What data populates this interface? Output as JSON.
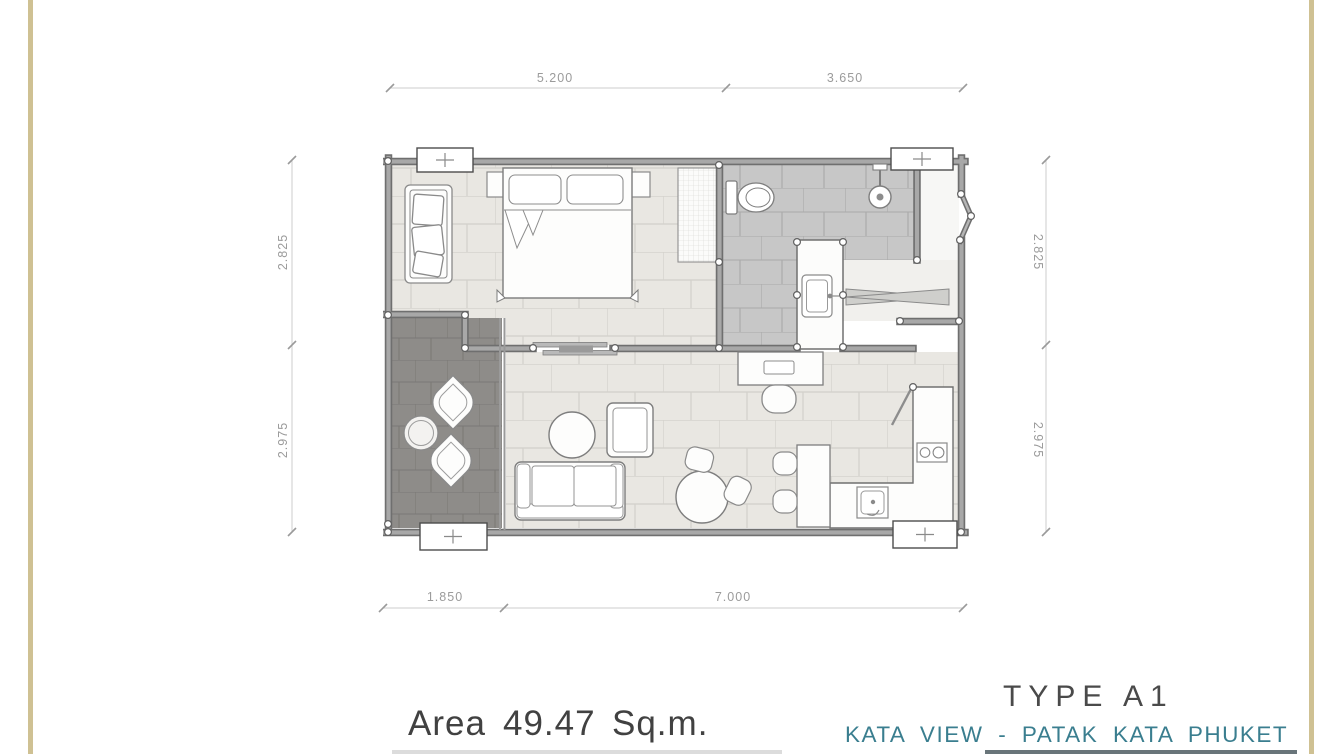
{
  "title_block": {
    "area_label": "Area",
    "area_value": "49.47",
    "area_unit": "Sq.m.",
    "type_label": "TYPE A1",
    "project_label": "KATA VIEW - PATAK KATA PHUKET"
  },
  "dimensions": {
    "top": [
      "5.200",
      "3.650"
    ],
    "left": [
      "2.825",
      "2.975"
    ],
    "right": [
      "2.825",
      "2.975"
    ],
    "bottom": [
      "1.850",
      "7.000"
    ]
  },
  "colors": {
    "gold_frame": "#cfc193",
    "teal_project": "#3a7e8f",
    "ink_text": "#414141",
    "dimension_text": "#9b9b9b",
    "wall_gray": "#a8a8a8",
    "wall_edge": "#6f6f6f",
    "floor_tile": "#e9e7e2",
    "bath_tile": "#c7c7c7",
    "balcony_tile": "#8e8c89"
  },
  "plan": {
    "rooms": [
      "bedroom",
      "bathroom",
      "dressing",
      "entry",
      "living-dining",
      "kitchen",
      "balcony"
    ],
    "column_marker_symbol": "+"
  }
}
